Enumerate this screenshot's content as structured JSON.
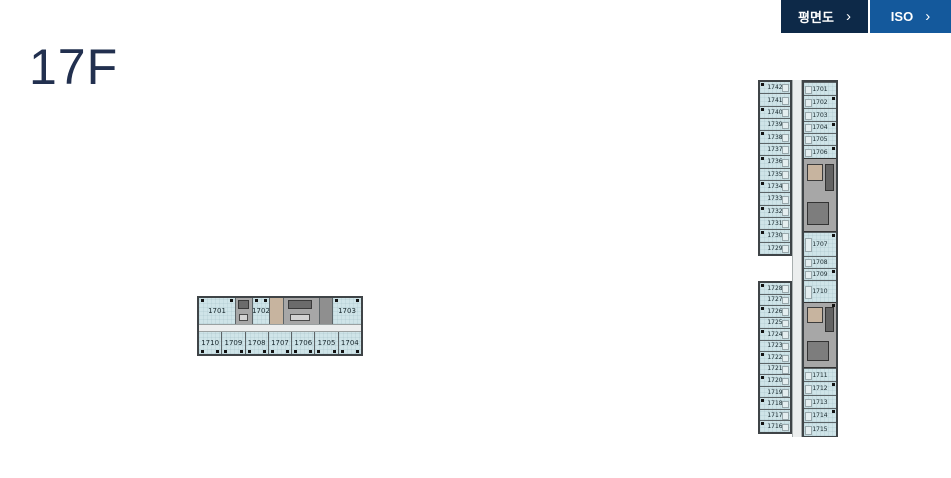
{
  "page": {
    "title": "17F"
  },
  "toolbar": {
    "buttons": [
      {
        "id": "plan",
        "label": "평면도"
      },
      {
        "id": "iso",
        "label": "ISO"
      }
    ]
  },
  "icons": {
    "chevron_right": "›"
  },
  "colors": {
    "button_plan_bg": "#0d2948",
    "button_iso_bg": "#14599c",
    "title_color": "#22304f",
    "unit_fill": "#cfe4e8",
    "core_fill": "#a7a7a7",
    "corridor_fill": "#eceeee",
    "outline": "#3f4447",
    "accent_tan": "#c7b49f"
  },
  "plan_horizontal": {
    "top_row": [
      {
        "type": "unit",
        "label": "1701",
        "w": 36
      },
      {
        "type": "core",
        "w": 17
      },
      {
        "type": "unit",
        "label": "1702",
        "w": 17
      },
      {
        "type": "lobby",
        "w": 14
      },
      {
        "type": "core",
        "w": 36
      },
      {
        "type": "core2",
        "w": 13
      },
      {
        "type": "unit",
        "label": "1703",
        "w": 29
      }
    ],
    "bottom_row": [
      "1710",
      "1709",
      "1708",
      "1707",
      "1706",
      "1705",
      "1704"
    ]
  },
  "plan_vertical": {
    "left_top": [
      "1742",
      "1741",
      "1740",
      "1739",
      "1738",
      "1737",
      "1736",
      "1735",
      "1734",
      "1733",
      "1732",
      "1731",
      "1730",
      "1729"
    ],
    "left_bottom": [
      "1728",
      "1727",
      "1726",
      "1725",
      "1724",
      "1723",
      "1722",
      "1721",
      "1720",
      "1719",
      "1718",
      "1717",
      "1716"
    ],
    "right_segments": [
      {
        "type": "unit",
        "label": "1701",
        "h": 13
      },
      {
        "type": "unit",
        "label": "1702",
        "h": 13
      },
      {
        "type": "unit",
        "label": "1703",
        "h": 13
      },
      {
        "type": "unit",
        "label": "1704",
        "h": 12
      },
      {
        "type": "unit",
        "label": "1705",
        "h": 12
      },
      {
        "type": "unit",
        "label": "1706",
        "h": 13
      },
      {
        "type": "core",
        "h": 74
      },
      {
        "type": "unit",
        "label": "1707",
        "h": 24
      },
      {
        "type": "unit",
        "label": "1708",
        "h": 12
      },
      {
        "type": "unit",
        "label": "1709",
        "h": 12
      },
      {
        "type": "unit",
        "label": "1710",
        "h": 22
      },
      {
        "type": "core",
        "h": 66
      },
      {
        "type": "unit",
        "label": "1711",
        "h": 13
      },
      {
        "type": "unit",
        "label": "1712",
        "h": 14
      },
      {
        "type": "unit",
        "label": "1713",
        "h": 13
      },
      {
        "type": "unit",
        "label": "1714",
        "h": 14
      },
      {
        "type": "unit",
        "label": "1715",
        "h": 14
      }
    ]
  }
}
